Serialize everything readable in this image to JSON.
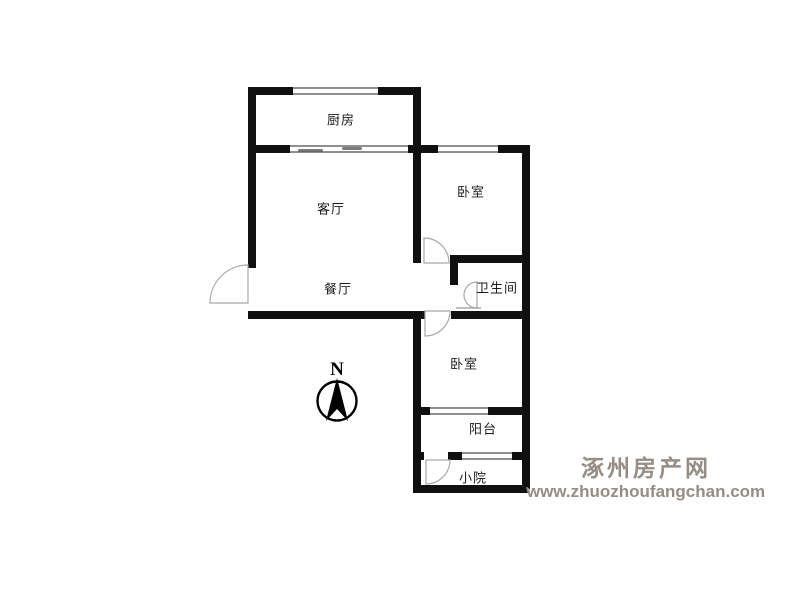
{
  "floorplan": {
    "rooms": [
      {
        "name": "kitchen",
        "label": "厨房"
      },
      {
        "name": "living-room",
        "label": "客厅"
      },
      {
        "name": "bedroom-north",
        "label": "卧室"
      },
      {
        "name": "dining-room",
        "label": "餐厅"
      },
      {
        "name": "bathroom",
        "label": "卫生间"
      },
      {
        "name": "bedroom-south",
        "label": "卧室"
      },
      {
        "name": "balcony",
        "label": "阳台"
      },
      {
        "name": "yard",
        "label": "小院"
      }
    ],
    "compass": {
      "label": "N"
    },
    "colors": {
      "wall": "#101010",
      "window_line": "#8f8f8f",
      "door_arc": "#a8a8a8",
      "room_label": "#1c1c1c"
    }
  },
  "watermark": {
    "site_name": "涿州房产网",
    "site_url": "www.zhuozhoufangchan.com",
    "color": "#968d84"
  }
}
